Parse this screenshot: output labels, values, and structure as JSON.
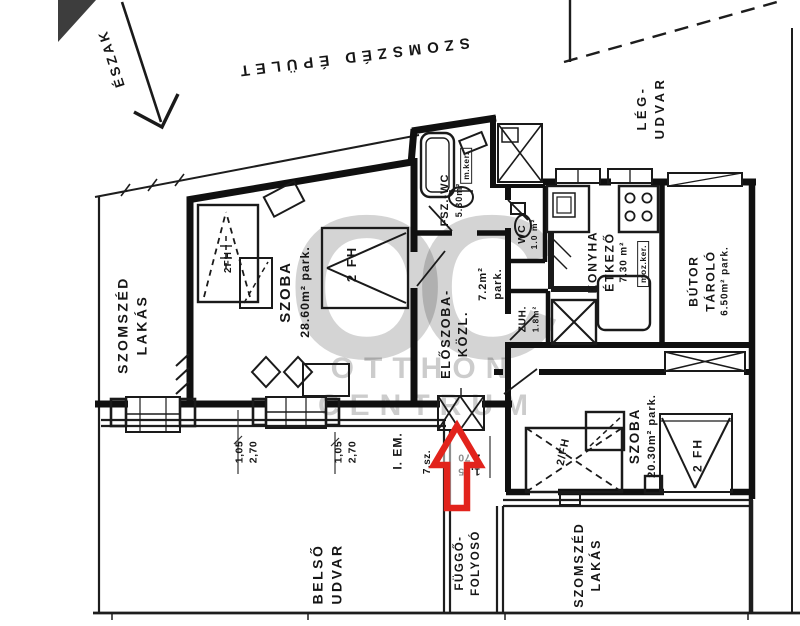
{
  "colors": {
    "ink": "#141414",
    "paper": "#ffffff",
    "watermark_gray": "#c9c9c9",
    "arrow_red": "#e2231c"
  },
  "compass": {
    "north_label": "ÉSZAK"
  },
  "context": {
    "neighbor_building": "SZOMSZÉD ÉPÜLET",
    "neighbor_flat_left": {
      "line1": "SZOMSZÉD",
      "line2": "LAKÁS"
    },
    "neighbor_flat_bottom": {
      "line1": "SZOMSZÉD",
      "line2": "LAKÁS"
    },
    "inner_courtyard": {
      "line1": "BELSŐ",
      "line2": "UDVAR"
    },
    "air_shaft": {
      "line1": "LÉG-",
      "line2": "UDVAR"
    },
    "open_corridor": {
      "line1": "FÜGGŐ-",
      "line2": "FOLYOSÓ"
    }
  },
  "rooms": {
    "szoba1": {
      "name": "SZOBA",
      "area": "28.60m² park."
    },
    "fsz_wc": {
      "name": "FSZ.-WC",
      "area": "5.30m²",
      "floor_note": "m.ker."
    },
    "wc": {
      "name": "WC",
      "area": "1.0 m²"
    },
    "konyha": {
      "name": "KONYHA",
      "name2": "ÉTKEZŐ",
      "area": "7.30 m²",
      "floor_note": "moz.ker."
    },
    "zuh": {
      "name": "ZUH.",
      "area": "1.8m²"
    },
    "eloszoba": {
      "name": "ELŐSZOBA-",
      "name2": "KÖZL.",
      "area": "7.2m²",
      "area2": "park."
    },
    "butor_tarolo": {
      "name": "BÚTOR",
      "name2": "TÁROLÓ",
      "area": "6.50m² park."
    },
    "szoba2": {
      "name": "SZOBA",
      "area": "20.30m² park."
    }
  },
  "beds": {
    "szoba1_bed": "2 FH",
    "szoba1_extra": "2FH",
    "szoba2_bed": "2/FH",
    "szoba2_window_bed": "2 FH"
  },
  "plan_meta": {
    "floor": "I. EM.",
    "unit_number": "7.sz."
  },
  "dimensions": {
    "window1": {
      "width": "1,05",
      "height": "2,70"
    },
    "window2": {
      "width": "1,05",
      "height": "2,70"
    },
    "entrance": {
      "width": "1,05",
      "height": "2,70"
    }
  },
  "watermark": {
    "monogram": "OC",
    "line1": "OTTHON",
    "line2": "CENTRUM"
  }
}
